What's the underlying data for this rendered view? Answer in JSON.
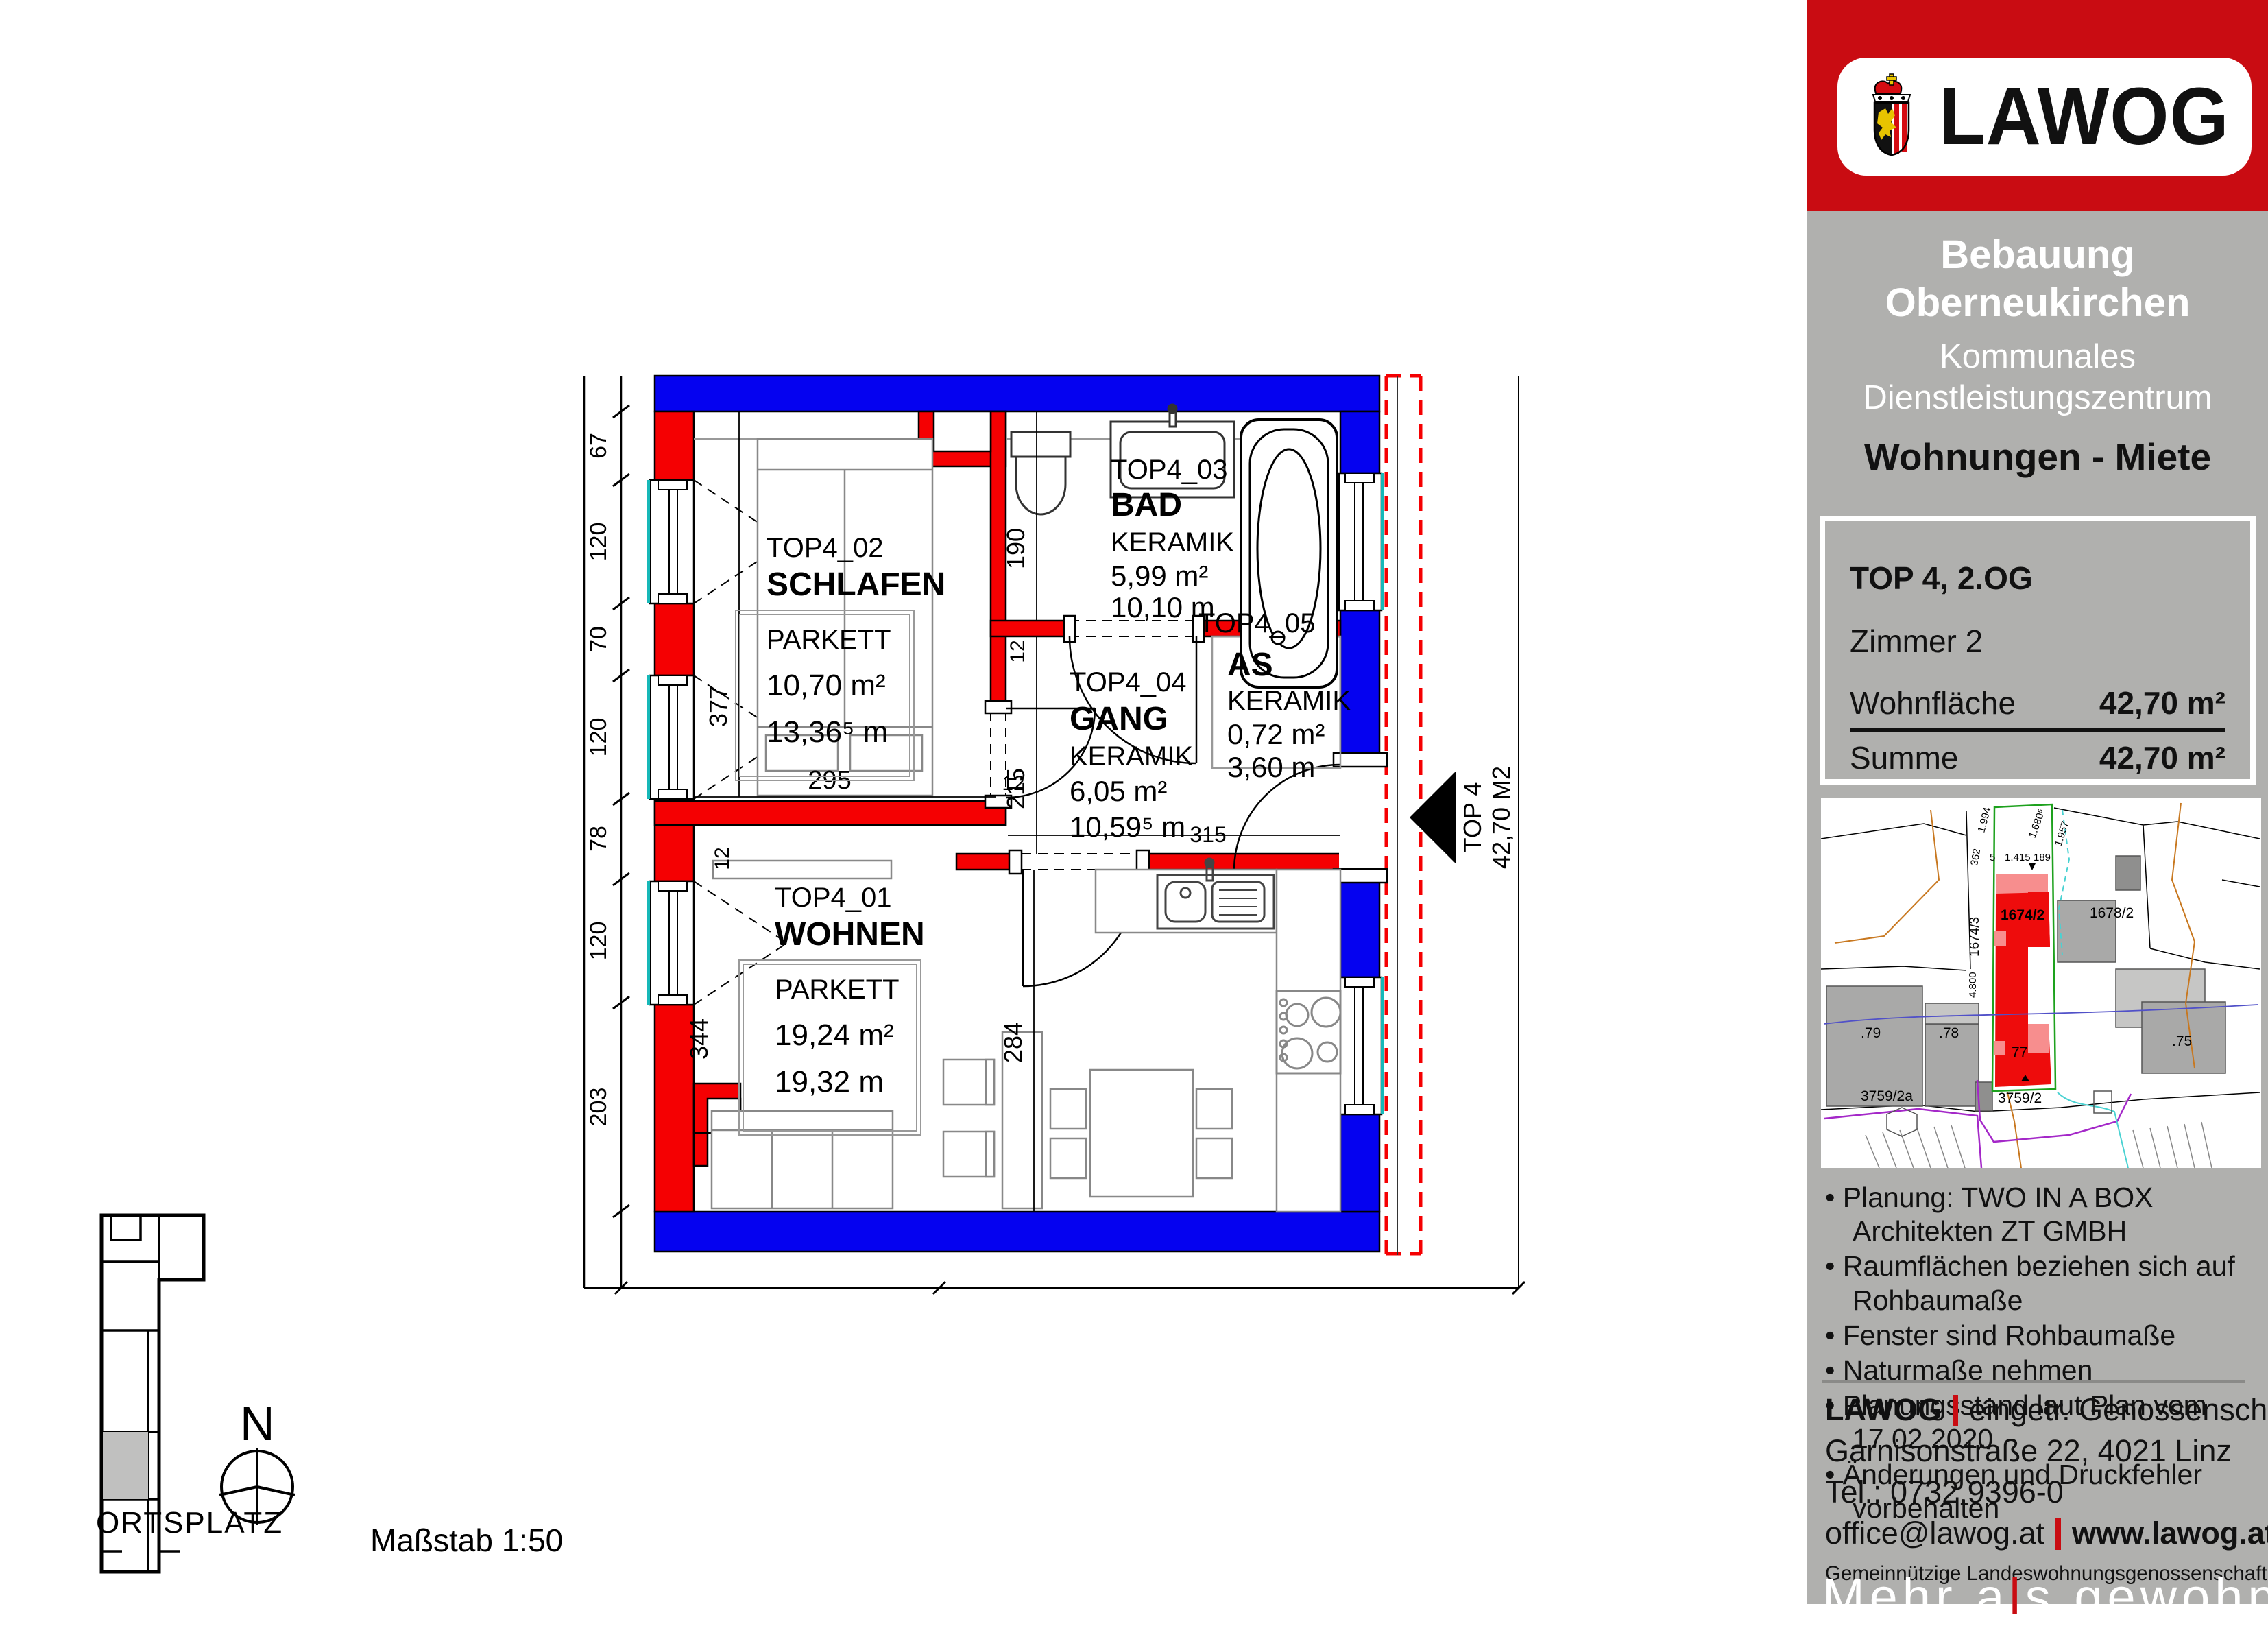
{
  "logo": {
    "text": "LAWOG"
  },
  "sidebar": {
    "title1": "Bebauung",
    "title2": "Oberneukirchen",
    "subtitle1": "Kommunales",
    "subtitle2": "Dienstleistungszentrum",
    "type_label": "Wohnungen - Miete",
    "info": {
      "line1": "TOP 4, 2.OG",
      "line2": "Zimmer 2",
      "rows": [
        {
          "label": "Wohnfläche",
          "value": "42,70 m²"
        },
        {
          "label": "Summe",
          "value": "42,70 m²"
        }
      ]
    },
    "notes": [
      "Planung: TWO IN A BOX Architekten ZT GMBH",
      "Raumflächen beziehen sich auf Rohbaumaße",
      "Fenster sind Rohbaumaße",
      "Naturmaße nehmen",
      "Planungsstand laut Plan vom 17.02.2020",
      "Änderungen und Druckfehler vorbehalten"
    ],
    "contact": {
      "name": "LAWOG",
      "name_rest": "eingetr. Genossenschaft m.b.H.",
      "address": "Garnisonstraße 22, 4021 Linz",
      "phone": "Tel.: 0732.9396-0",
      "email": "office@lawog.at",
      "web": "www.lawog.at",
      "coop": "Gemeinnützige Landeswohnungsgenossenschaft für Oberösterreich"
    },
    "slogan": {
      "part1": "Mehr a",
      "accent": "l",
      "part2": "s gewohnt"
    }
  },
  "map": {
    "labels": [
      "1674/2",
      "1674/3",
      "1678/2",
      ".79",
      ".78",
      "77",
      ".75",
      "3759/2a",
      "3759/2"
    ],
    "dims": [
      "1.994",
      "362",
      "5",
      "1.415",
      "189",
      "1.680⁵",
      "1.957",
      "4.800"
    ]
  },
  "plan": {
    "rooms": [
      {
        "id": "TOP4_01",
        "name": "WOHNEN",
        "floor": "PARKETT",
        "area": "19,24 m²",
        "perimeter": "19,32 m"
      },
      {
        "id": "TOP4_02",
        "name": "SCHLAFEN",
        "floor": "PARKETT",
        "area": "10,70 m²",
        "perimeter": "13,36⁵ m"
      },
      {
        "id": "TOP4_03",
        "name": "BAD",
        "floor": "KERAMIK",
        "area": "5,99 m²",
        "perimeter": "10,10 m"
      },
      {
        "id": "TOP4_04",
        "name": "GANG",
        "floor": "KERAMIK",
        "area": "6,05 m²",
        "perimeter": "10,59⁵ m"
      },
      {
        "id": "TOP4_05",
        "name": "AS",
        "floor": "KERAMIK",
        "area": "0,72 m²",
        "perimeter": "3,60 m"
      }
    ],
    "marker": {
      "line1": "TOP 4",
      "line2": "42,70 M2"
    },
    "dims": {
      "left": [
        "67",
        "120",
        "70",
        "120",
        "78",
        "120",
        "203"
      ],
      "v377": "377",
      "v190": "190",
      "v215": "215",
      "v284": "284",
      "v344": "344",
      "h295": "295",
      "h315": "315",
      "w12a": "12",
      "w12b": "12",
      "w12c": "12"
    }
  },
  "footer": {
    "ortsplatz": "ORTSPLATZ",
    "north": "N",
    "scale": "Maßstab 1:50"
  }
}
